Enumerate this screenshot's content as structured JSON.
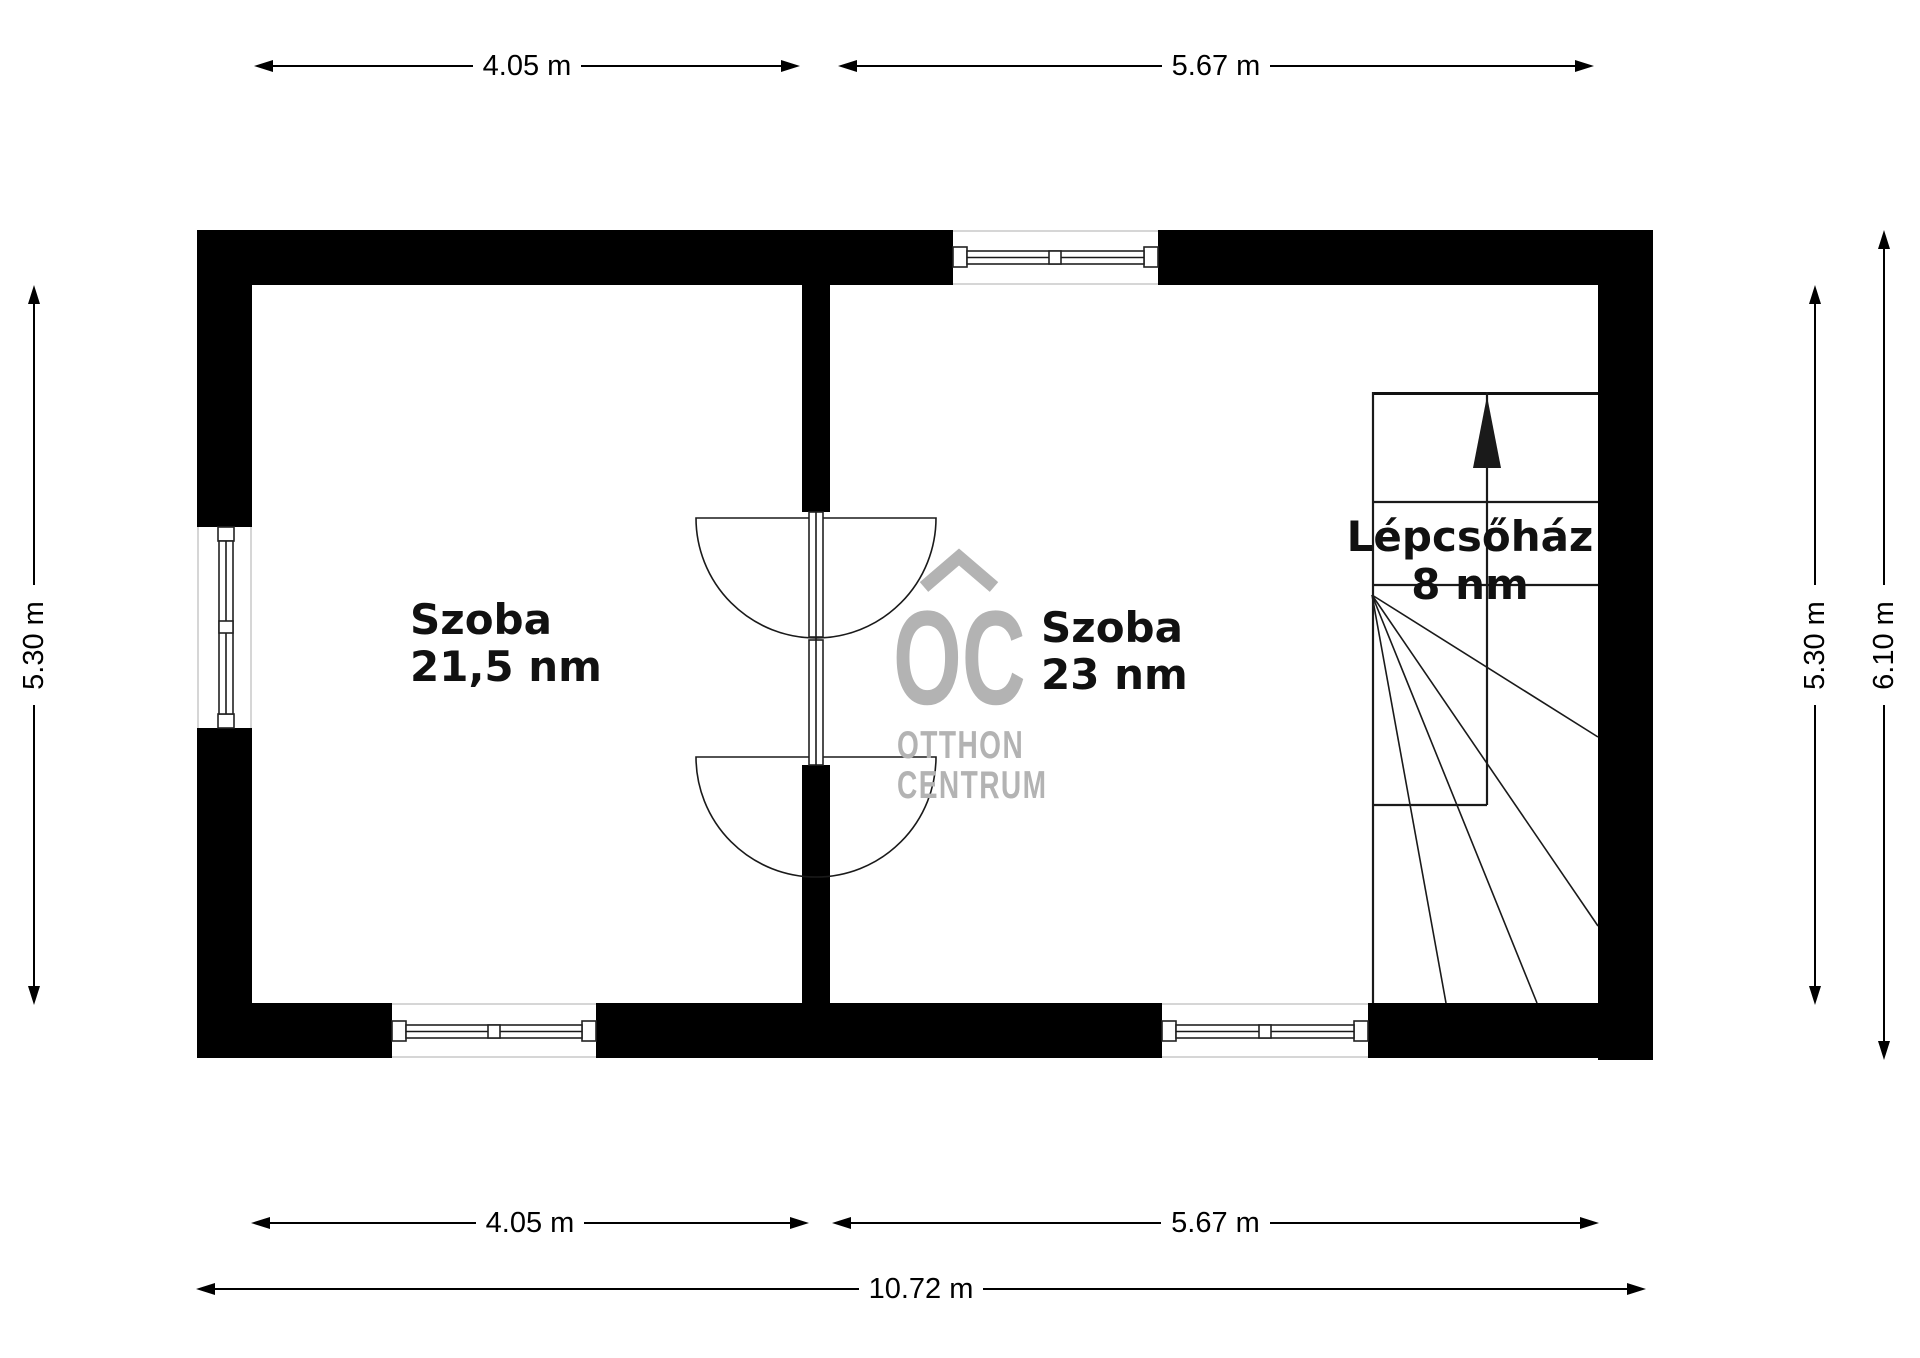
{
  "title": "Emeleti alaprajz",
  "rooms": {
    "room1": {
      "name": "Szoba",
      "area": "21,5 nm"
    },
    "room2": {
      "name": "Szoba",
      "area": "23 nm"
    },
    "stairwell": {
      "name": "Lépcsőház",
      "area": "8 nm"
    }
  },
  "dimensions": {
    "top_left": "4.05 m",
    "top_right": "5.67 m",
    "bottom_left": "4.05 m",
    "bottom_right": "5.67 m",
    "bottom_total": "10.72 m",
    "left_inner": "5.30 m",
    "right_inner": "5.30 m",
    "right_outer": "6.10 m"
  },
  "watermark": {
    "logo": "OC",
    "name_line1": "OTTHON",
    "name_line2": "CENTRUM",
    "color": "#b3b3b3"
  },
  "symbols": {
    "stair_direction": "up-arrow"
  },
  "colors": {
    "wall": "#000000",
    "lines": "#1a1a1a",
    "background": "#ffffff",
    "dimension_text": "#000000",
    "room_text": "#111111"
  }
}
